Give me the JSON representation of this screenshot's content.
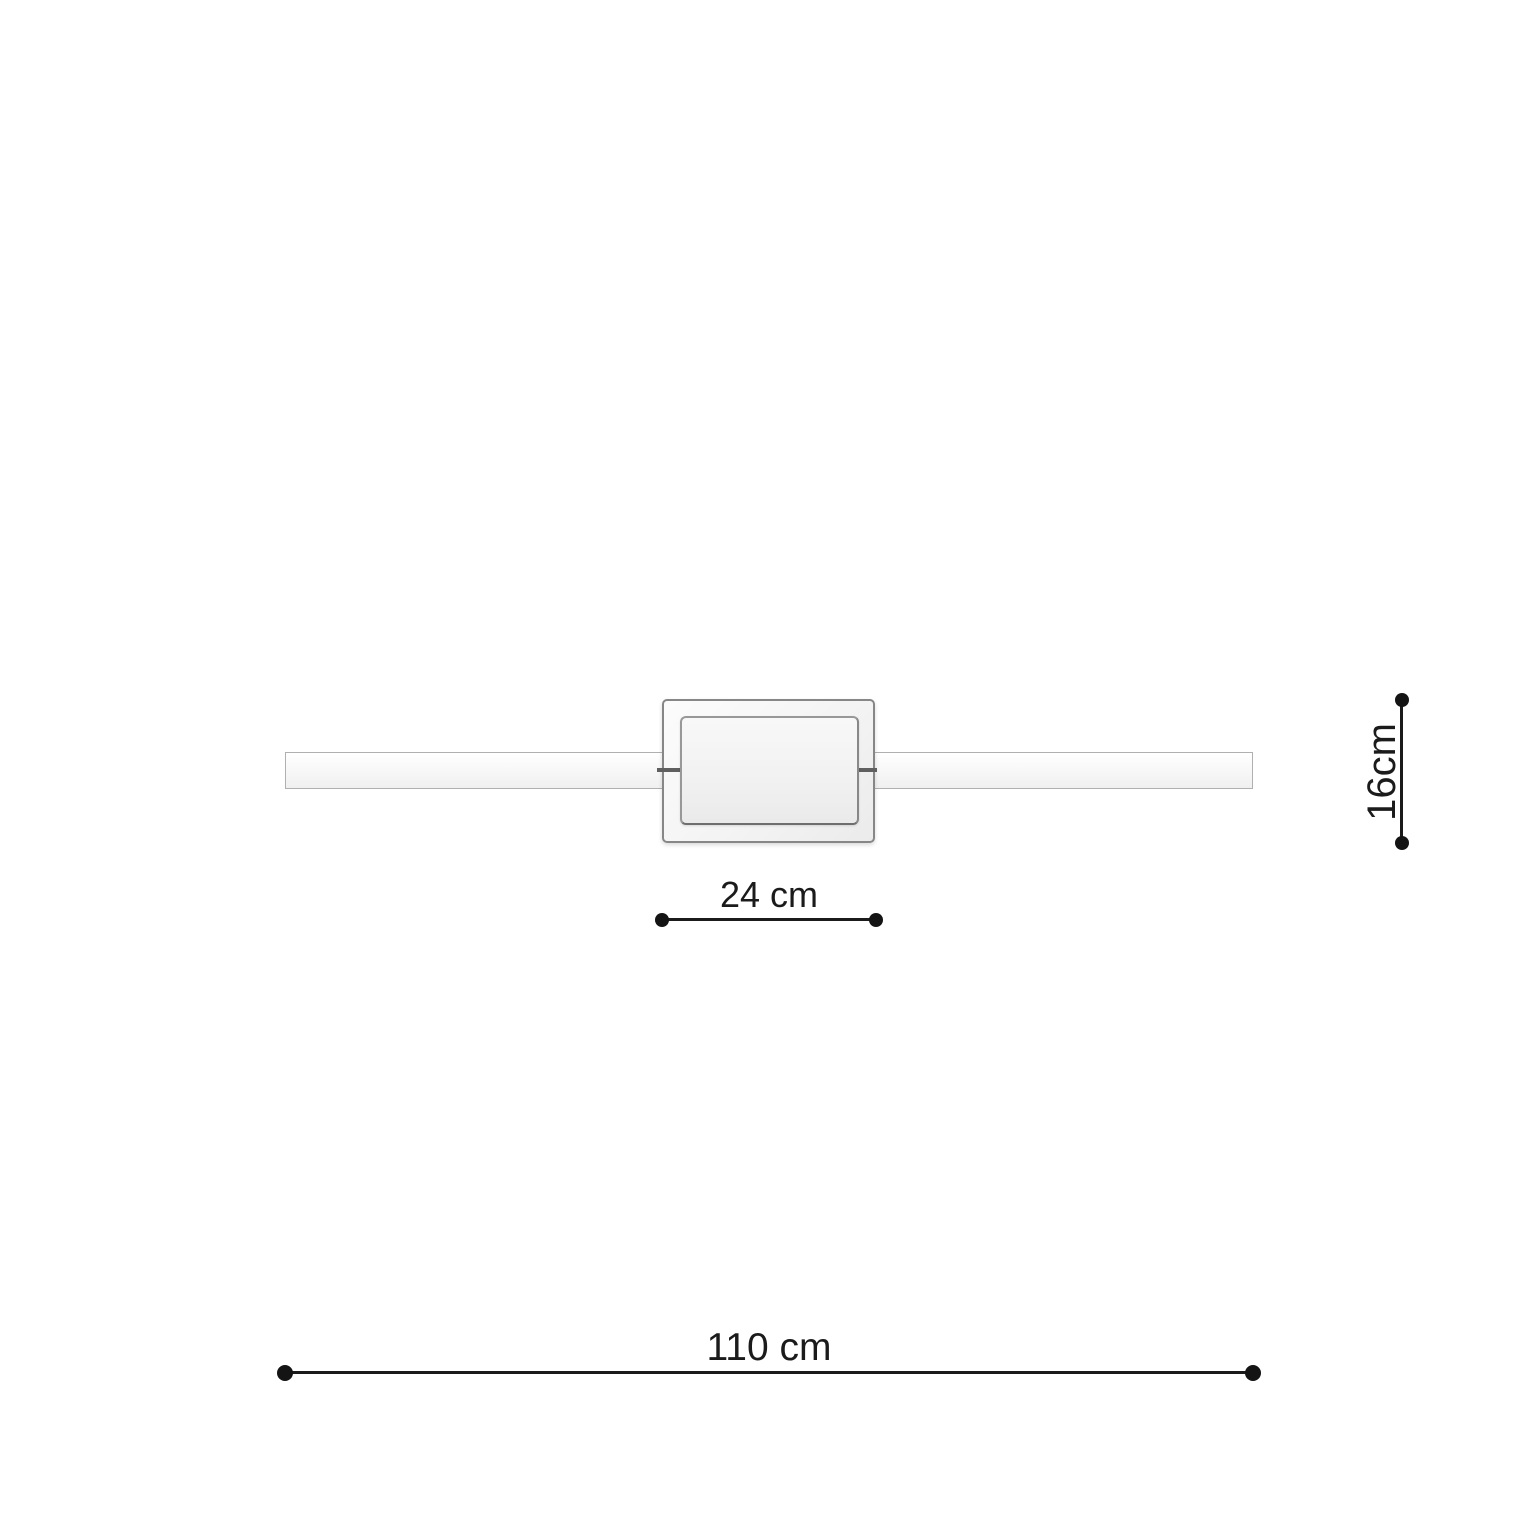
{
  "diagram": {
    "dimensions": {
      "plate_width": {
        "label": "24 cm",
        "value": 24,
        "unit": "cm"
      },
      "plate_height": {
        "label": "16cm",
        "value": 16,
        "unit": "cm"
      },
      "total_width": {
        "label": "110 cm",
        "value": 110,
        "unit": "cm"
      }
    },
    "colors": {
      "background": "#ffffff",
      "dimension_line": "#1b1b1b",
      "dimension_text": "#1b1b1b",
      "fixture_outline": "#878787",
      "fixture_fill": "#f3f3f3"
    }
  }
}
